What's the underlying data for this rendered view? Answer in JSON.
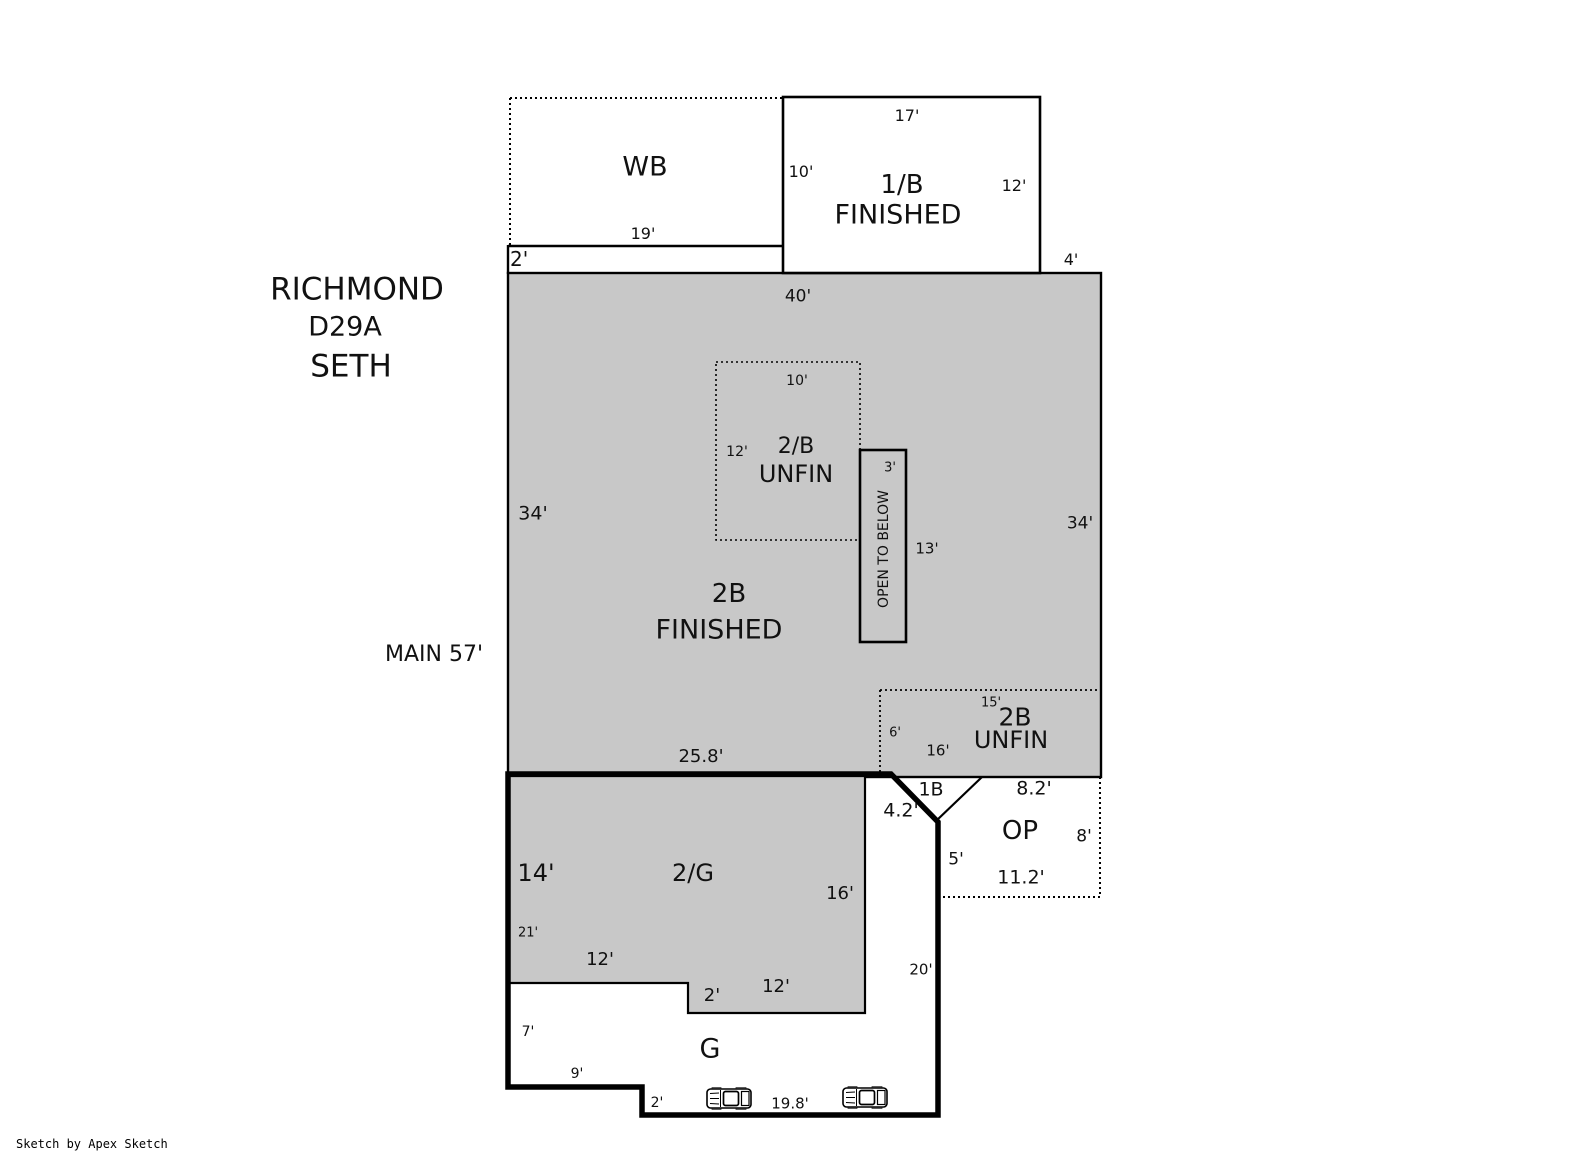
{
  "header": {
    "model": "RICHMOND",
    "plan_code": "D29A",
    "elevation": "SETH",
    "floor_note": "MAIN 57'"
  },
  "rooms": {
    "wb": "WB",
    "half_bath": "1/B",
    "half_bath_status": "FINISHED",
    "bed_2b": "2/B",
    "bed_2b_status": "UNFIN",
    "open_to_below": "OPEN TO BELOW",
    "upper_2b": "2B",
    "upper_2b_status": "FINISHED",
    "unfin_2b": "2B",
    "unfin_2b_status": "UNFIN",
    "stair_1b": "1B",
    "porch_op": "OP",
    "garage_upper": "2/G",
    "garage": "G"
  },
  "dims": {
    "hb_top": "17'",
    "hb_left": "10'",
    "hb_right": "12'",
    "wb_bottom": "19'",
    "strip": "2'",
    "main_gap": "4'",
    "main_top": "40'",
    "main_left": "34'",
    "main_right": "34'",
    "bed_top": "10'",
    "bed_left": "12'",
    "otb_width": "3'",
    "otb_height": "13'",
    "unfin_top": "15'",
    "unfin_left": "6'",
    "unfin_bottom": "16'",
    "main_bottom": "25.8'",
    "stair_diag": "4.2'",
    "op_top": "8.2'",
    "op_right": "8'",
    "op_left": "5'",
    "op_bottom": "11.2'",
    "tg_left": "14'",
    "tg_right": "16'",
    "tg_inner": "21'",
    "tg_bottom_left": "12'",
    "tg_step": "2'",
    "tg_bottom_right": "12'",
    "gar_right": "20'",
    "gar_left": "7'",
    "gar_bottom_left": "9'",
    "gar_step": "2'",
    "gar_bottom": "19.8'"
  },
  "footer": {
    "credit": "Sketch by Apex Sketch"
  },
  "colors": {
    "area_fill": "#c8c8c8",
    "line": "#000000"
  }
}
